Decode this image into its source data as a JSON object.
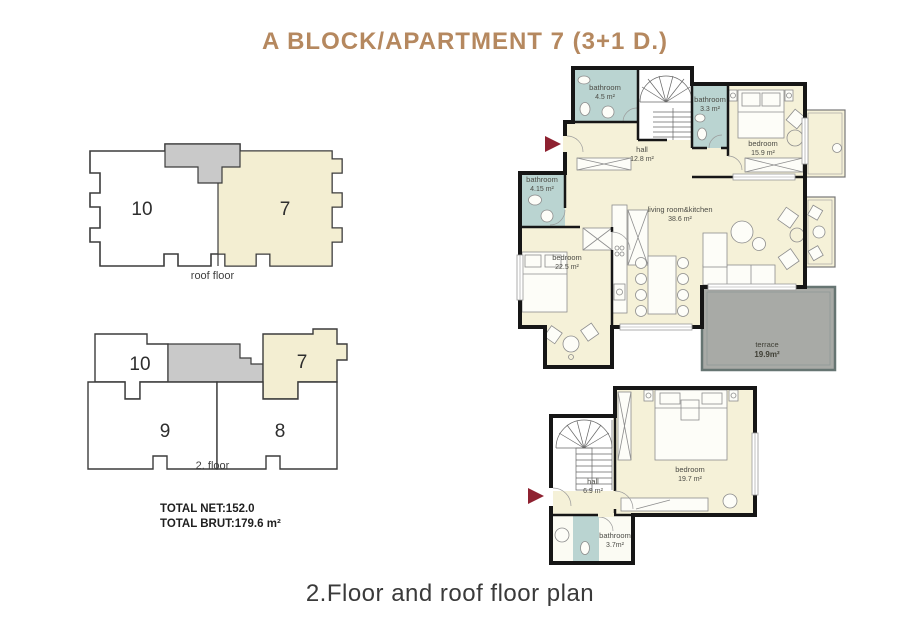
{
  "title": "A BLOCK/APARTMENT 7 (3+1 D.)",
  "caption": "2.Floor and roof floor plan",
  "totals": {
    "net": "TOTAL NET:152.0",
    "brut": "TOTAL BRUT:179.6 m²"
  },
  "key_plans": {
    "roof": {
      "label": "roof floor",
      "unit_left": "10",
      "unit_right": "7"
    },
    "second": {
      "label": "2. floor",
      "unit_top_left": "10",
      "unit_top_right": "7",
      "unit_bottom_left": "9",
      "unit_bottom_right": "8"
    }
  },
  "plans": {
    "upper": {
      "rooms": {
        "bathroom1": {
          "name": "bathroom",
          "area": "4.5 m²"
        },
        "bathroom2": {
          "name": "bathroom",
          "area": "3.3 m²"
        },
        "bedroom1": {
          "name": "bedroom",
          "area": "15.9 m²"
        },
        "hall": {
          "name": "hall",
          "area": "12.8 m²"
        },
        "bathroom3": {
          "name": "bathroom",
          "area": "4.15 m²"
        },
        "bedroom2": {
          "name": "bedroom",
          "area": "22.5 m²"
        },
        "living": {
          "name": "living room&kitchen",
          "area": "38.6 m²"
        },
        "terrace": {
          "name": "terrace",
          "area": "19.9m²"
        }
      }
    },
    "lower": {
      "rooms": {
        "hall": {
          "name": "hall",
          "area": "6.9 m²"
        },
        "bedroom": {
          "name": "bedroom",
          "area": "19.7 m²"
        },
        "bathroom": {
          "name": "bathroom",
          "area": "3.7m²"
        }
      }
    }
  },
  "colors": {
    "accent": "#b5885f",
    "cream": "#f5f1d8",
    "bathroom_blue": "#bad4d1",
    "terrace_gray": "#a8aaa6",
    "common_gray": "#c9c9c9",
    "arrow_red": "#8e2130"
  }
}
